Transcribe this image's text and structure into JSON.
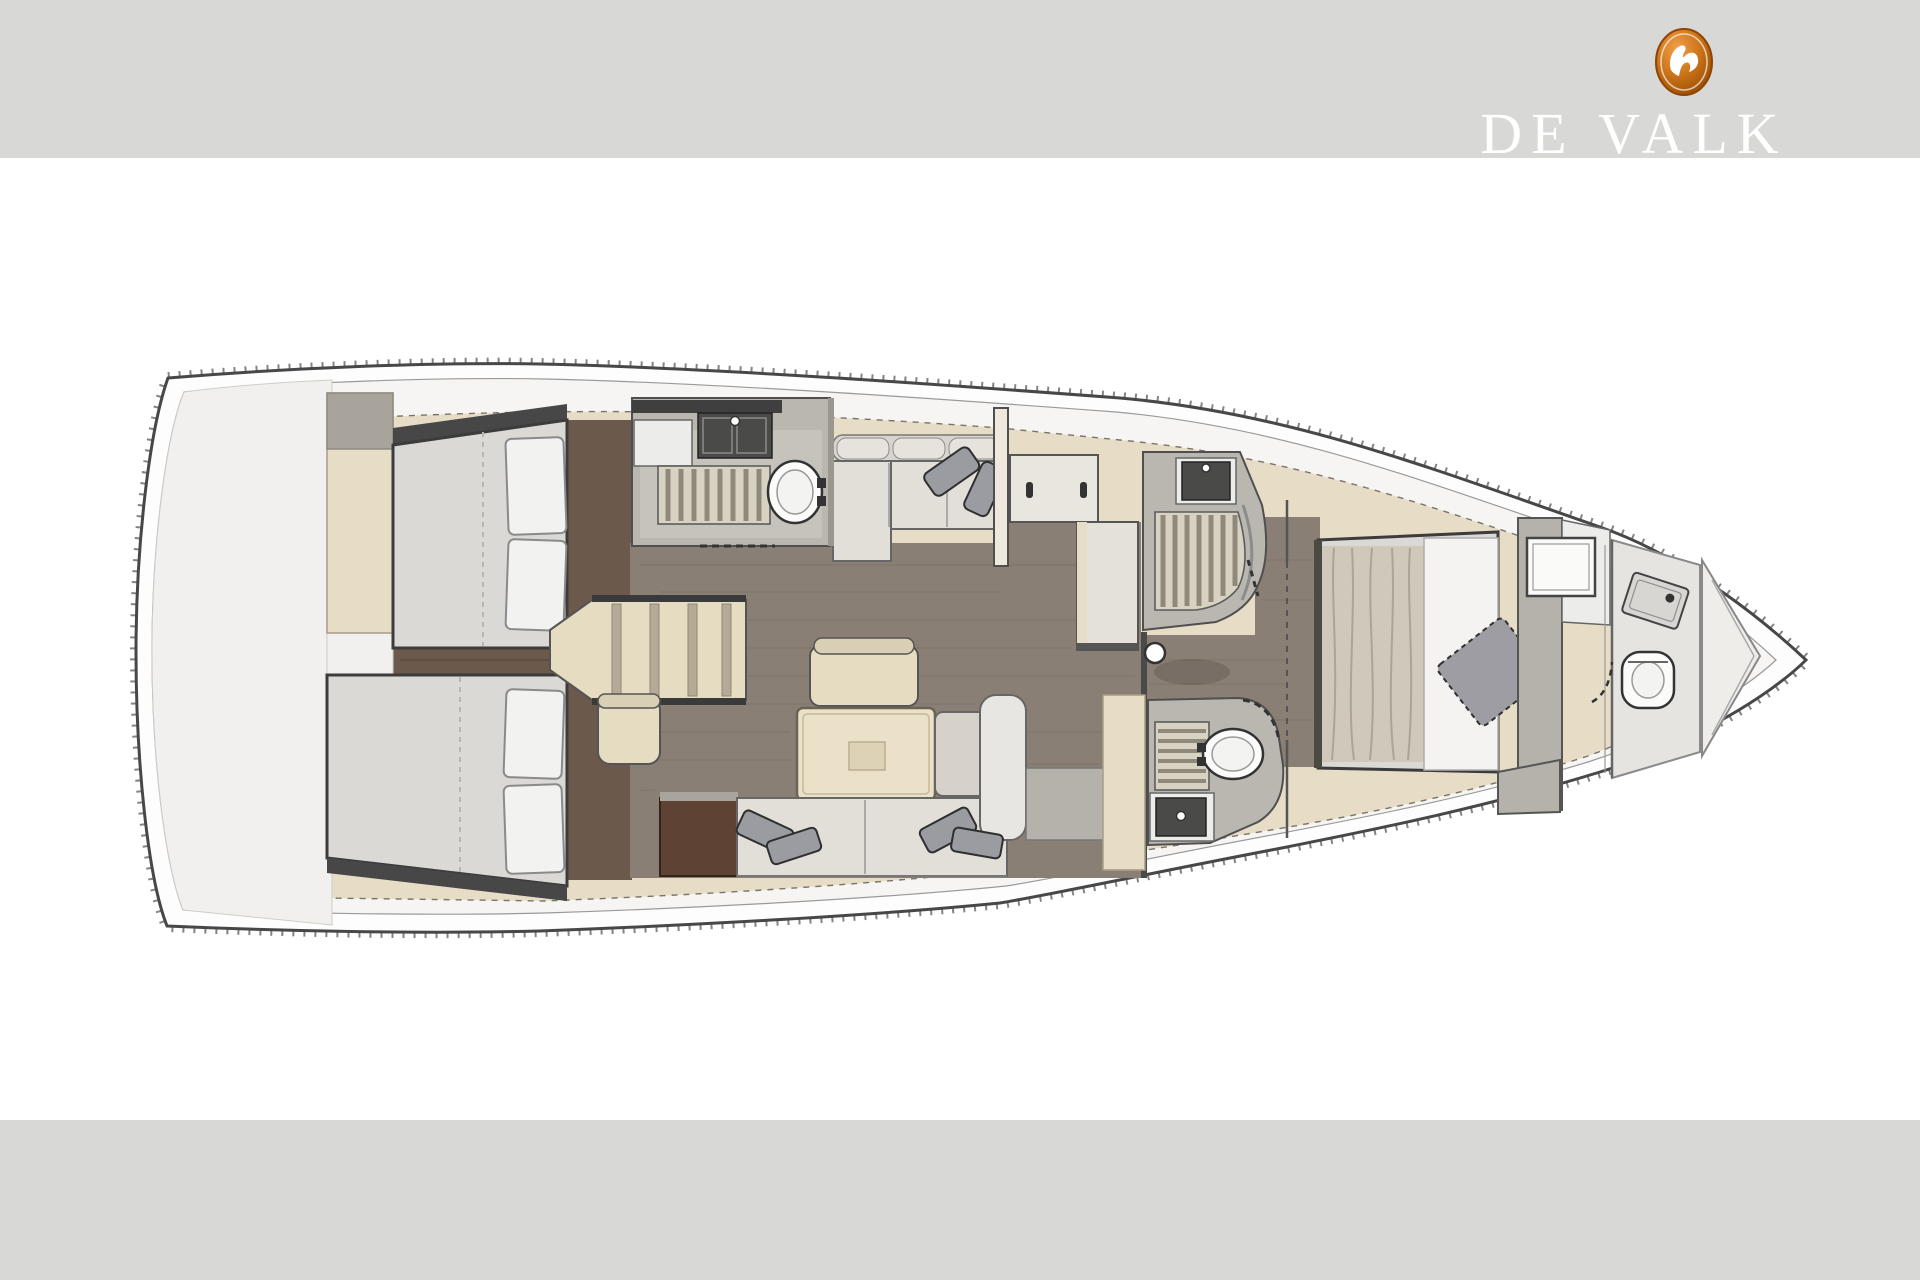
{
  "brand": {
    "logo_text": "DE VALK",
    "logo_icon": "falcon-icon"
  },
  "colors": {
    "canvas": "#ffffff",
    "bar_gray": "#d8d8d6",
    "brand_orange": "#d0791e",
    "brand_orange_dark": "#8f4503",
    "brand_orange_light": "#f2a04a",
    "logo_text": "#ffffff",
    "hull_white": "#fdfdfd",
    "hull_line": "#474747",
    "deck_white": "#f6f5f3",
    "coachroof_cream": "#e7ddc6",
    "cockpit_white": "#f1f0ee",
    "floor_brown": "#8a7f75",
    "floor_dark": "#6b5a4c",
    "walnut_dark": "#5e4233",
    "room_gray": "#bab7b1",
    "grate_teak": "#d7d2c2",
    "grate_slat": "#8f897b",
    "mattress": "#dad9d5",
    "pillow_white": "#f2f2f1",
    "sofa_light": "#e2dfd9",
    "cushion_gray": "#9b9ca2",
    "furniture_cream": "#e6dcc2",
    "fixture_dark": "#4a4a48",
    "white_fixture": "#fbfbfa",
    "outline": "#3c3c3c"
  },
  "floorplan": {
    "type": "yacht-interior-deck-plan-top-view",
    "orientation": "bow-right",
    "rooms": [
      "cockpit-stern-deck",
      "aft-cabin-port",
      "aft-cabin-starboard",
      "companionway-stairs",
      "day-head",
      "salon-settee",
      "nav-station",
      "shower-room-mid",
      "salon-dinette",
      "head-mid",
      "owners-cabin-forward",
      "bow-head",
      "anchor-locker"
    ],
    "fixtures": [
      "toilet",
      "sink",
      "shower-grate",
      "double-bed",
      "pillows",
      "saloon-table",
      "sofa",
      "chair",
      "stool",
      "mast-post",
      "wardrobe",
      "mirror"
    ]
  }
}
